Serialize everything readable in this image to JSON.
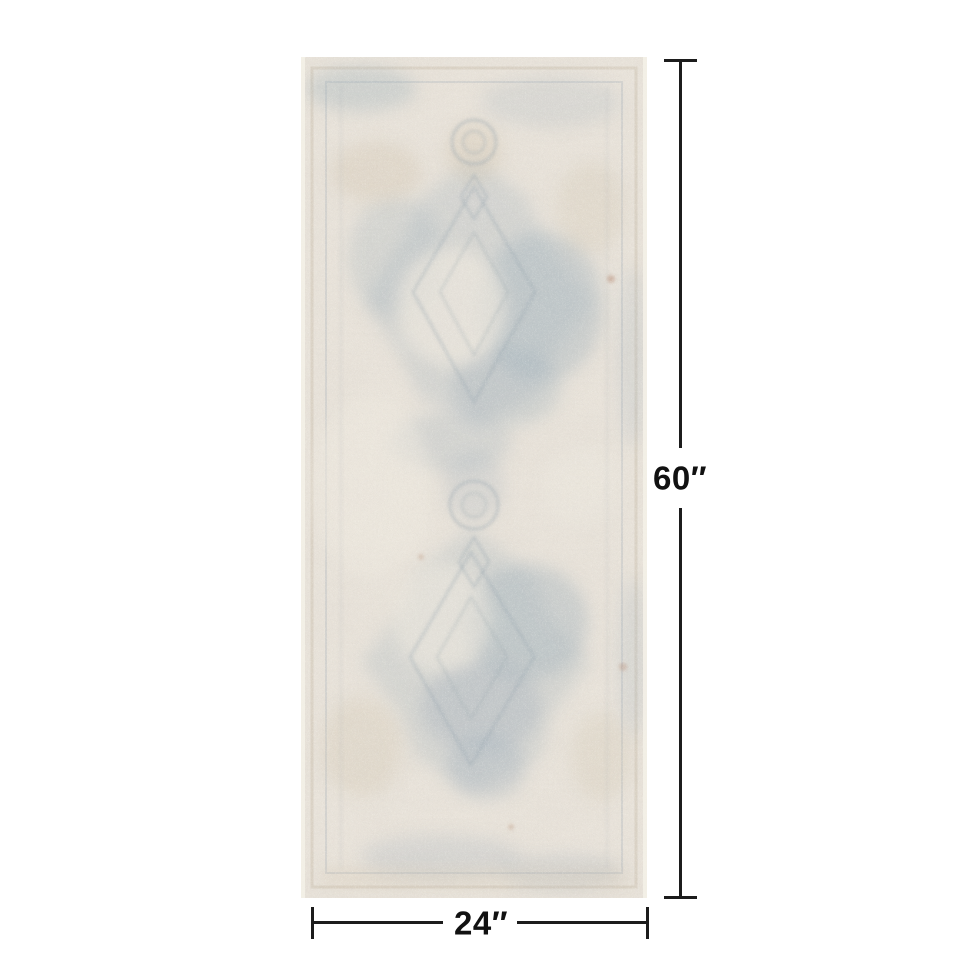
{
  "diagram": {
    "type": "product-size-diagram",
    "background_color": "#ffffff",
    "rug": {
      "description": "Distressed vintage medallion runner rug, ivory greige with faded slate blue pattern",
      "base_color": "#e8e2d9",
      "pattern_color": "#8da2b2",
      "accent_color": "#c6b69c",
      "selvage_color": "#f4f1e8"
    },
    "dimensions": {
      "height_label": "60″",
      "width_label": "24″",
      "line_color": "#1c1c1c",
      "label_color": "#111111"
    }
  }
}
